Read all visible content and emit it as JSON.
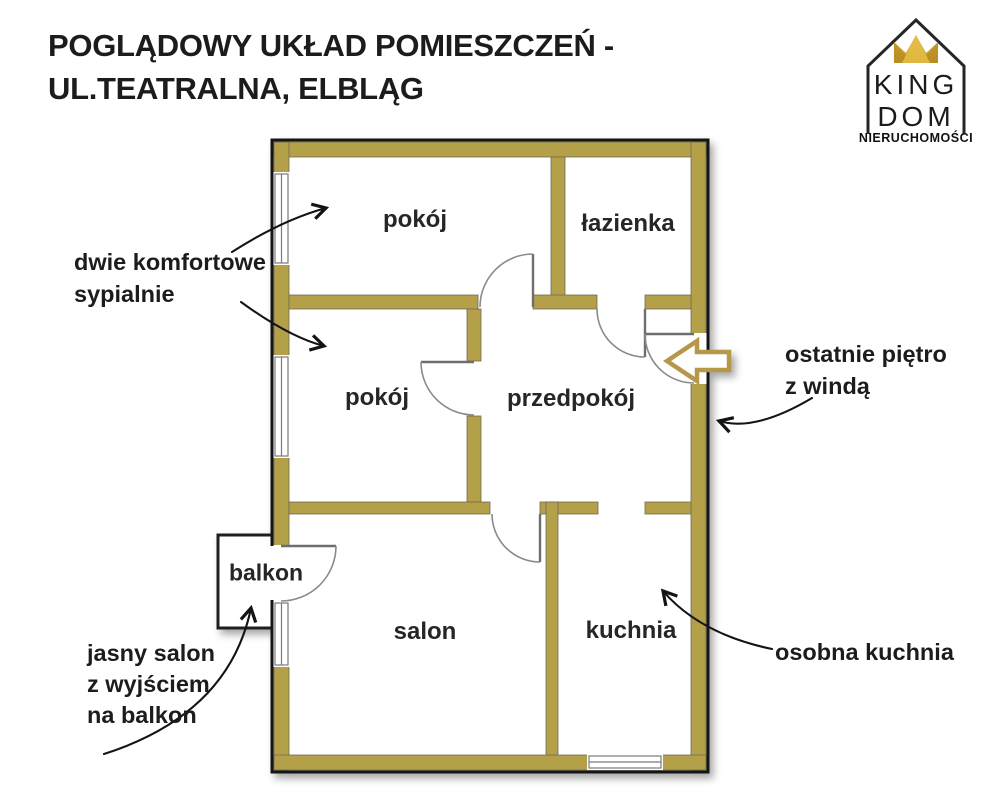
{
  "header": {
    "title_line1": "POGLĄDOWY UKŁAD POMIESZCZEŃ -",
    "title_line2": "UL.TEATRALNA, ELBLĄG"
  },
  "logo": {
    "name_top": "KING",
    "name_bottom": "DOM",
    "tagline": "NIERUCHOMOŚCI"
  },
  "floorplan": {
    "rooms": [
      {
        "id": "bedroom-1",
        "label": "pokój"
      },
      {
        "id": "bathroom",
        "label": "łazienka"
      },
      {
        "id": "bedroom-2",
        "label": "pokój"
      },
      {
        "id": "hallway",
        "label": "przedpokój"
      },
      {
        "id": "living-room",
        "label": "salon"
      },
      {
        "id": "kitchen",
        "label": "kuchnia"
      },
      {
        "id": "balcony",
        "label": "balkon"
      }
    ],
    "colors": {
      "wall_fill": "#b5a04a",
      "outline": "#151515",
      "entrance_arrow": "#b5984a",
      "crown_gold_light": "#e8c553",
      "crown_gold_dark": "#b88c20"
    }
  },
  "annotations": [
    {
      "id": "bedrooms-note",
      "text": "dwie komfortowe\nsypialnie"
    },
    {
      "id": "top-floor-note",
      "text": "ostatnie piętro\nz windą"
    },
    {
      "id": "kitchen-note",
      "text": "osobna kuchnia"
    },
    {
      "id": "balcony-note",
      "text": "jasny salon\nz wyjściem\nna balkon"
    }
  ]
}
